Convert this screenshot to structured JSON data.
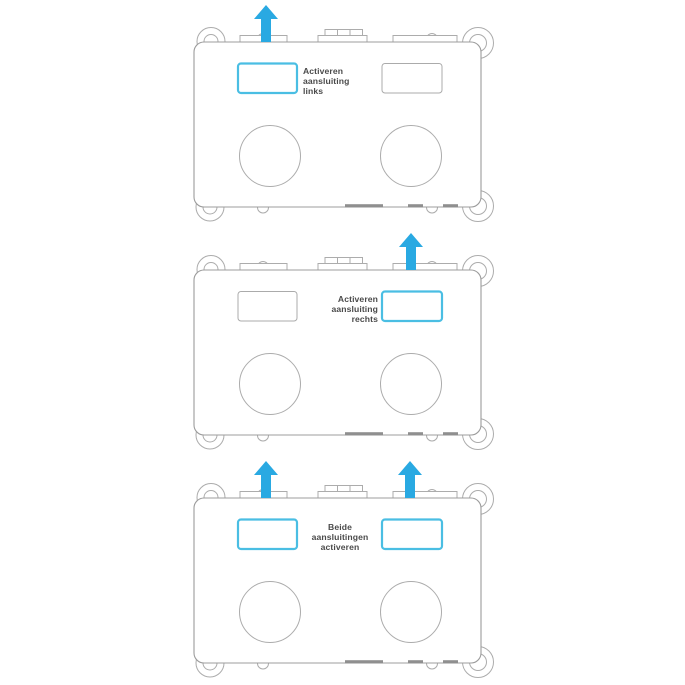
{
  "colors": {
    "arrow": "#29A9E2",
    "highlight": "#4ABEE3",
    "inactive": "#ABABAB",
    "outline": "#9C9C9C",
    "text": "#4A4A4A"
  },
  "panels": [
    {
      "name": "activate-left-connection",
      "label": {
        "line1": "Activeren",
        "line2": "aansluiting",
        "line3": "links"
      },
      "left_slot": {
        "stroke": "#4ABEE3",
        "stroke_width": "2.2"
      },
      "right_slot": {
        "stroke": "#ABABAB",
        "stroke_width": "1"
      }
    },
    {
      "name": "activate-right-connection",
      "label": {
        "line1": "Activeren",
        "line2": "aansluiting",
        "line3": "rechts"
      },
      "left_slot": {
        "stroke": "#ABABAB",
        "stroke_width": "1"
      },
      "right_slot": {
        "stroke": "#4ABEE3",
        "stroke_width": "2.2"
      }
    },
    {
      "name": "activate-both-connections",
      "label": {
        "line1": "Beide",
        "line2": "aansluitingen",
        "line3": "activeren"
      },
      "left_slot": {
        "stroke": "#4ABEE3",
        "stroke_width": "2.2"
      },
      "right_slot": {
        "stroke": "#4ABEE3",
        "stroke_width": "2.2"
      }
    }
  ]
}
